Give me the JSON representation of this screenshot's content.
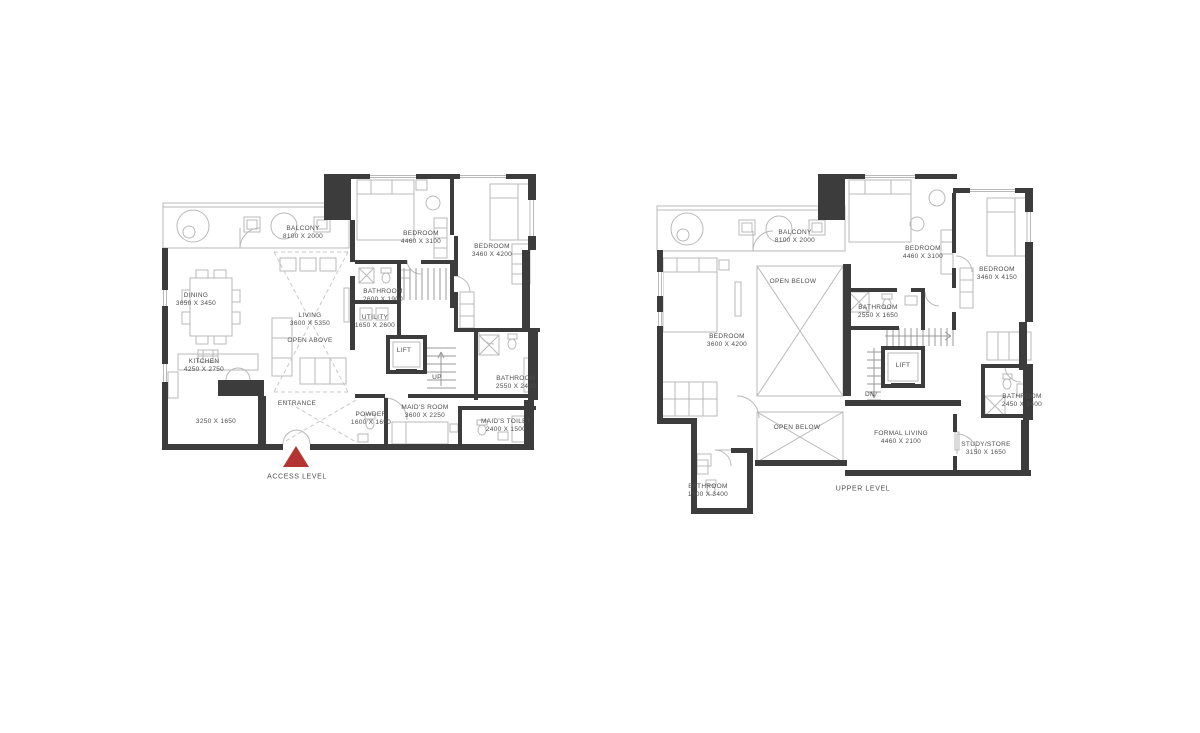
{
  "sheet": {
    "background": "#ffffff"
  },
  "colors": {
    "wall": "#3c3c3c",
    "outline": "#b9b9b9",
    "dashed": "#c8c8c8",
    "text": "#4d4d4d",
    "marker_red": "#b23532"
  },
  "plans": [
    {
      "id": "access-level",
      "caption": "ACCESS LEVEL",
      "rooms": [
        {
          "name": "BALCONY",
          "dims": "8100 X 2000"
        },
        {
          "name": "DINING",
          "dims": "3650 X 3450"
        },
        {
          "name": "LIVING",
          "dims": "3600 X 5350"
        },
        {
          "name": "OPEN ABOVE",
          "dims": ""
        },
        {
          "name": "KITCHEN",
          "dims": "4250 X 2750"
        },
        {
          "name": "",
          "dims": "3250 X 1650"
        },
        {
          "name": "ENTRANCE",
          "dims": ""
        },
        {
          "name": "POWDER",
          "dims": "1600 X 1650"
        },
        {
          "name": "MAID'S ROOM",
          "dims": "3600 X 2250"
        },
        {
          "name": "MAID'S TOILET",
          "dims": "2400 X 1500"
        },
        {
          "name": "BEDROOM",
          "dims": "4460 X 3100"
        },
        {
          "name": "BEDROOM",
          "dims": "3460 X 4200"
        },
        {
          "name": "BATHROOM",
          "dims": "2600 X 1900"
        },
        {
          "name": "BATHROOM",
          "dims": "2550 X 2400"
        },
        {
          "name": "UTILITY",
          "dims": "1650 X 2600"
        },
        {
          "name": "LIFT",
          "dims": ""
        },
        {
          "name": "UP",
          "dims": ""
        }
      ]
    },
    {
      "id": "upper-level",
      "caption": "UPPER LEVEL",
      "rooms": [
        {
          "name": "BALCONY",
          "dims": "8100 X 2000"
        },
        {
          "name": "OPEN BELOW",
          "dims": ""
        },
        {
          "name": "BEDROOM",
          "dims": "3600 X 4200"
        },
        {
          "name": "BEDROOM",
          "dims": "4460 X 3100"
        },
        {
          "name": "BEDROOM",
          "dims": "3460 X 4150"
        },
        {
          "name": "BATHROOM",
          "dims": "2550 X 1650"
        },
        {
          "name": "LIFT",
          "dims": ""
        },
        {
          "name": "DN",
          "dims": ""
        },
        {
          "name": "BATHROOM",
          "dims": "2450 X 2400"
        },
        {
          "name": "OPEN BELOW",
          "dims": ""
        },
        {
          "name": "FORMAL LIVING",
          "dims": "4460 X 2100"
        },
        {
          "name": "STUDY/STORE",
          "dims": "3150 X 1650"
        },
        {
          "name": "BATHROOM",
          "dims": "1900 X 3400"
        }
      ]
    }
  ]
}
